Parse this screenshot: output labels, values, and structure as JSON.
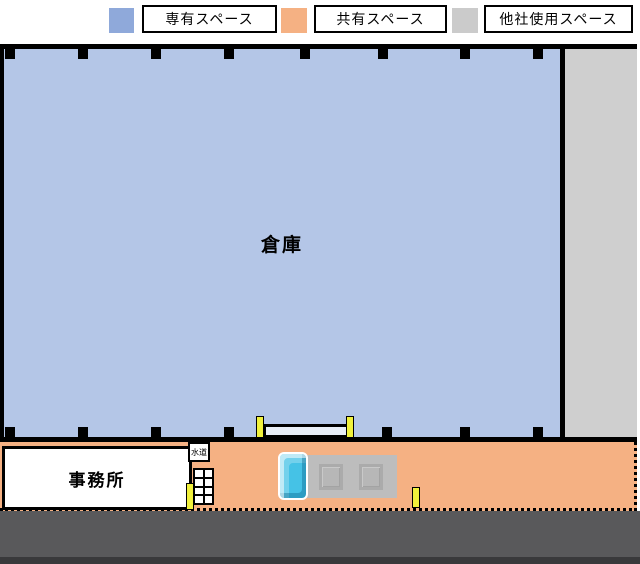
{
  "legend": {
    "items": [
      {
        "label": "専有スペース",
        "color": "#8FA9DA"
      },
      {
        "label": "共有スペース",
        "color": "#F5B183"
      },
      {
        "label": "他社使用スペース",
        "color": "#CBCBCB"
      }
    ]
  },
  "areas": {
    "warehouse": {
      "label": "倉庫",
      "color": "#B4C6E7"
    },
    "shared_yard": {
      "color": "#F5B183"
    },
    "other_company": {
      "color": "#CFCFCF"
    },
    "office": {
      "label": "事務所"
    },
    "water_supply": {
      "label": "水道"
    },
    "road": {
      "color": "#59595B"
    },
    "road_edge": {
      "color": "#39393B"
    }
  },
  "objects": {
    "post_color": "#F1F13C",
    "truck": {
      "cab_color": "#45C2E6",
      "bed_color": "#BDBDBD"
    },
    "gate_fill": "#E8EEF7"
  }
}
